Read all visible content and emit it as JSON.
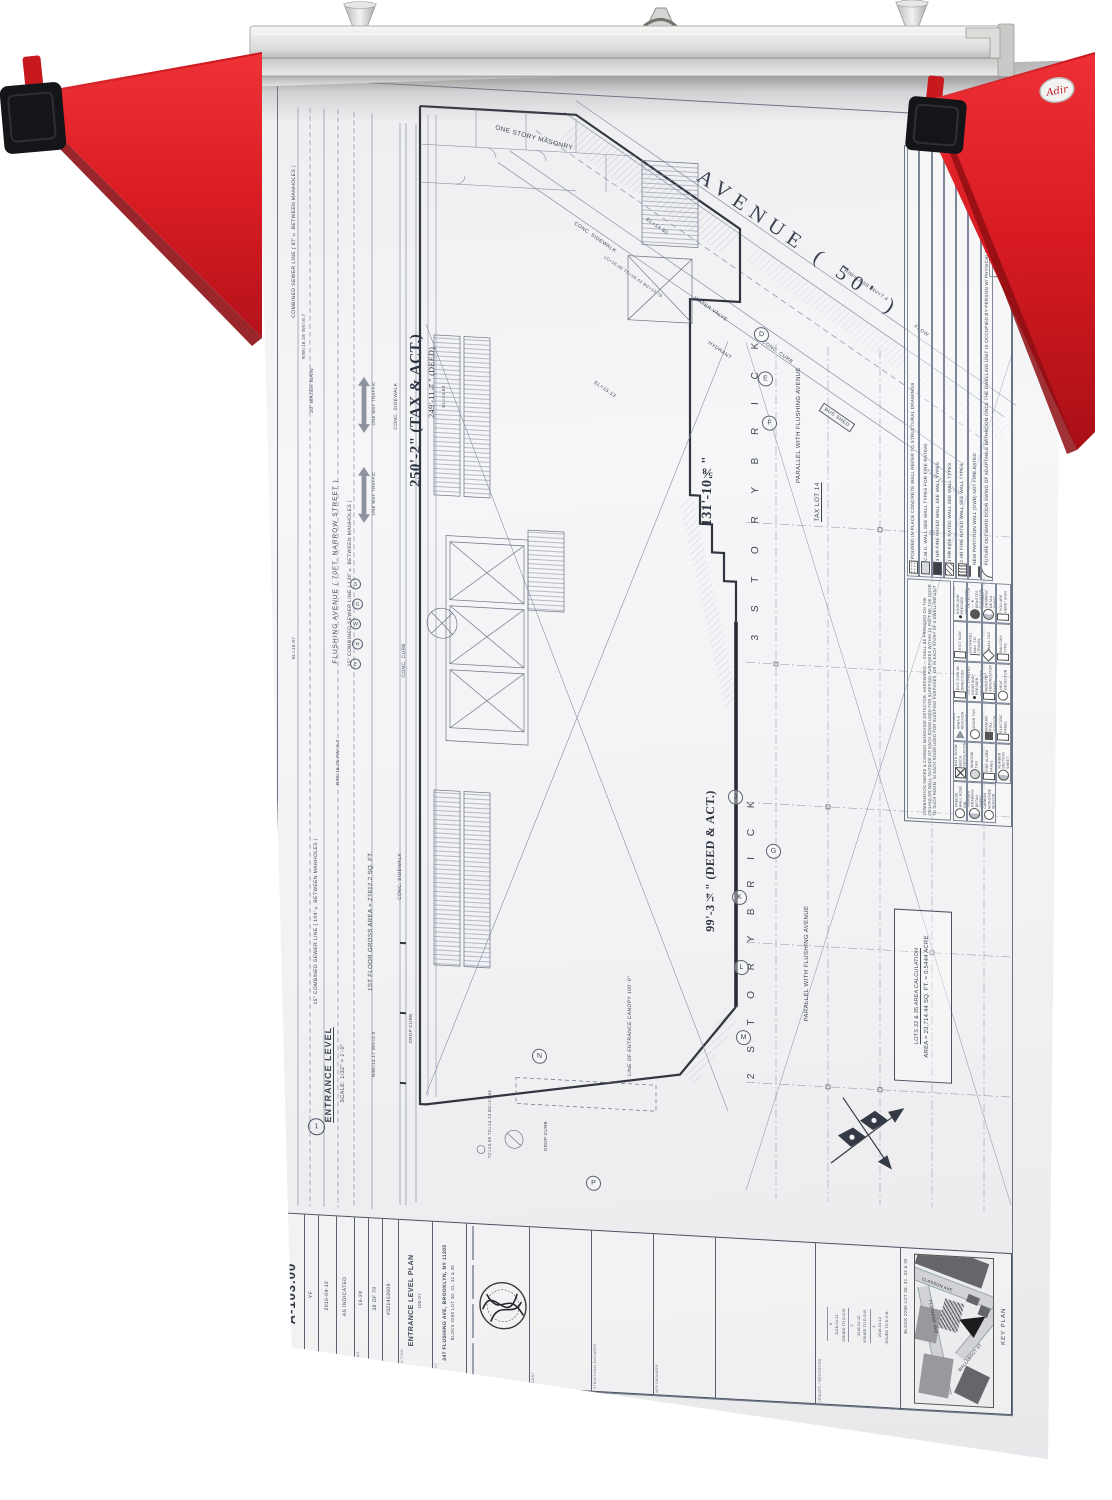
{
  "rack": {
    "brand": "Adir"
  },
  "plan": {
    "avenue": "AVENUE  ( 50' )",
    "one_story_masonry": "ONE STORY MASONRY",
    "conc_sidewalk": "CONC. SIDEWALK",
    "conc_curb": "CONC. CURB",
    "bus_shed": "BUS SHED",
    "water_valve": "WATER VALVE",
    "hydrant": "HYDRANT",
    "flow": "FLOW",
    "traffic_sign": "TRAFFIC SIGN",
    "el_14_80": "EL=14.80",
    "el_15_13": "EL=15.13",
    "el_14_63": "EL=14.63",
    "el_15_97": "EL=15.97",
    "rim_14_59": "RIM=14.59  INV=7.4",
    "rim_15_25": "RIM=15.25  INV=6.2",
    "rim_16_18": "RIM=16.18  INV=6.7",
    "rim_14_17": "RIM=14.17  INV=2.0",
    "lc_16": "LC=16.00  TC=16.42  BC=15.78",
    "tc_13": "TC=13.65  TC=14.13  BC=13.64",
    "dim_250": "250'-2\" (TAX & ACT.)",
    "dim_249": "249'-11¾\" (DEED)",
    "dim_131": "131'-10⅝\"",
    "dim_99": "99'-3¼\" (DEED & ACT.)",
    "story_3": "3  S T O R Y   B R I C K",
    "story_2": "2  S T O R Y   B R I C K",
    "tax_lot": "TAX LOT 14",
    "parallel": "PARALLEL WITH FLUSHING AVENUE",
    "flushing_avenue": "FLUSHING AVENUE ( 70FT. NARROW STREET )",
    "sewer_130": "15\" COMBINED SEWER LINE ( 130'± BETWEEN MANHOLES )",
    "sewer_104": "15\" COMBINED SEWER LINE ( 104'± BETWEEN MANHOLES )",
    "sewer_87": "COMBINED SEWER LINE ( 87'± BETWEEN MANHOLES )",
    "water_main": "20' WATER MAIN",
    "one_way": "ONE WAY TRAFFIC",
    "gross_area": "1ST FLOOR GROSS AREA = 27812.2 SQ. FT.",
    "drop_curb": "DROP CURB",
    "canopy": "LINE OF ENTRANCE CANOPY 100'-0\"",
    "area_calc_title": "LOTS 32 & 35 AREA CALCULATION",
    "area_calc_value": "AREA = 23,714.44 SQ. FT. = 0.5444 ACRE",
    "view_title": "ENTRANCE LEVEL",
    "view_scale": "SCALE: 1/32\" = 1'-0\"",
    "view_tag": "1",
    "grid_letters": [
      "D",
      "E",
      "F",
      "G",
      "J",
      "K",
      "L",
      "M",
      "N",
      "P"
    ],
    "utility_letters": [
      "S",
      "G",
      "W",
      "H",
      "E"
    ]
  },
  "legend": {
    "title": "LEGEND",
    "walls": [
      {
        "sym": "conc",
        "label": "POURED IN PLACE CONCRETE WALL REFER TO STRUCTURAL DRAWINGS"
      },
      {
        "sym": "cmu",
        "label": "C.M.U. WALL SEE WALL TYPES FOR FIRE RATING"
      },
      {
        "sym": "rated3",
        "label": "3 HR FIRE RATED WALL SEE WALL TYPES"
      },
      {
        "sym": "rated1",
        "label": "1 HR FIRE RATED WALL SEE WALL TYPES"
      },
      {
        "sym": "rated2",
        "label": "2 HR FIRE RATED WALL SEE WALL TYPES"
      },
      {
        "sym": "gwb",
        "label": "NEW PARTITION WALL (GWB) NOT FIRE RATED"
      },
      {
        "sym": "door-swing",
        "label": "FUTURE OUTWARD DOOR SWING OF ADAPTABLE BATHROOM ONCE THE DWELLING UNIT IS OCCUPIED BY PERSON W/ PHYSICAL DISABILITY"
      }
    ],
    "paragraph": "COMBINATION SMOKE & CARBON MONOXIDE DETECTOR, HARDWIRED — SHALL BE PROVIDED ON THE CEILING OR WALL OUTSIDE OF EACH ROOM USED FOR SLEEPING PURPOSES WITHIN 15 FEET OF THE DOOR TO SUCH ROOM, IN EACH ROOM USED FOR SLEEPING PURPOSES, OR IN EACH STORY OF A DWELLING UNIT",
    "symbols": [
      {
        "sym": "dot2",
        "label": "INDICATES 1 1/2 HR. FIRE RATED U.L.C. LABELED DOOR AND PRESSED STEEL FRAME WITH DOOR CLOSER"
      },
      {
        "sym": "exit",
        "label": "EXIT SIGN"
      },
      {
        "sym": "exit-dir",
        "label": "EXIT SIGN W/ DIRECTION"
      },
      {
        "sym": "rev",
        "label": "REVISED AREA & REVISION NUMBER"
      },
      {
        "sym": "vent",
        "label": "BATH ROOM MECH VENTILATION"
      },
      {
        "sym": "hose",
        "label": "NON-FREEZE WALL HOSE BIB (RECESSED)"
      },
      {
        "sym": "smoke",
        "label": "SMOKE DETECTOR — ★ DENOTES ELEVATOR RECALL"
      },
      {
        "sym": "td",
        "label": "ACTUAL T.D. (TRAVEL DISTANCE) MAX. T.D. (TRAVEL DISTANCE ALLOWED)"
      },
      {
        "sym": "dot1",
        "label": "INDICATES 3/4 HR. FIRE RATED U.L.C. LABELED DOOR AND PRESSED STEEL FRAME WITH DOOR CLOSER"
      },
      {
        "sym": "door-tag",
        "label": "DOOR TAG"
      },
      {
        "sym": "win-tag",
        "label": "WINDOW TAG"
      },
      {
        "sym": "elev-no",
        "label": "ELEVATION NUMBER DRAWING DETAIL SHEET NUMBER"
      },
      {
        "sym": "detail-no",
        "label": "DETAIL NUMBER DRAWING DETAIL SHEET NUMBER"
      },
      {
        "sym": "wall-tag",
        "label": "WALL TAG"
      },
      {
        "sym": "rap",
        "label": "FIRE ALARM REMOTE ANNUNCIATOR PANEL"
      },
      {
        "sym": "pull",
        "label": "FIRE ALARM MANUAL PULL STATION"
      },
      {
        "sym": "fap",
        "label": "FIRE ALARM PANEL"
      },
      {
        "sym": "co-sensor",
        "label": "CARBON MONOXIDE SENSOR"
      },
      {
        "sym": "here",
        "label": "\"YOU ARE HERE\" SIGN"
      },
      {
        "sym": "balcony",
        "label": "BALCONY TYPE"
      },
      {
        "sym": "heat",
        "label": "HEAT DETECTOR"
      },
      {
        "sym": "ep",
        "label": "ELECTRIC PANEL"
      },
      {
        "sym": "section-no",
        "label": "SECTION NUMBER SECTION SHEET NUMBER"
      }
    ]
  },
  "titleblock": {
    "labels": {
      "drawing_no": "DRAWING NO.",
      "drawn": "DRAWN",
      "date": "DATE",
      "scale": "SCALE",
      "project_no": "PROJECT NO.",
      "sheet": "SHEET",
      "drawing_title": "DRAWING TITLE",
      "project": "PROJECT",
      "client": "CLIENT",
      "structural": "STRUCTURAL ENGINEER",
      "mep": "MEP ENGINEER",
      "issues": "ISSUES / REVISIONS",
      "key_plan": "KEY PLAN"
    },
    "drawing_no": "A-103.00",
    "drawn": "YF",
    "date": "2016-04-12",
    "scale": "AS INDICATED",
    "project_no": "16-24",
    "sheet": "38 OF 70",
    "job_no": "#321453609",
    "drawing_title": "ENTRANCE LEVEL PLAN",
    "title_note": "100-07",
    "project_addr1": "347 FLUSHING AVE, BROOKLYN, NY 11205",
    "project_addr2": "BLOCK 2260 LOT 30, 31, 32 & 35",
    "architect": "KARL FISCHER ARCHITECT",
    "seal": "REGISTERED ARCHITECT",
    "revisions": [
      {
        "no": "3",
        "date": "2016-04-12",
        "desc": "ISSUED TO D.O.B."
      },
      {
        "no": "2",
        "date": "2016-04-12",
        "desc": "ISSUED TO D.O.B."
      },
      {
        "no": "1",
        "date": "2016-04-12",
        "desc": "ISSUED TO D.O.B."
      }
    ],
    "key_plan": {
      "block": "BLOCK 2260 LOT 30, 31, 32 & 35",
      "streets": [
        "CLASSON AVE",
        "FLUSHING AVE",
        "WALLABOUT ST"
      ]
    }
  }
}
